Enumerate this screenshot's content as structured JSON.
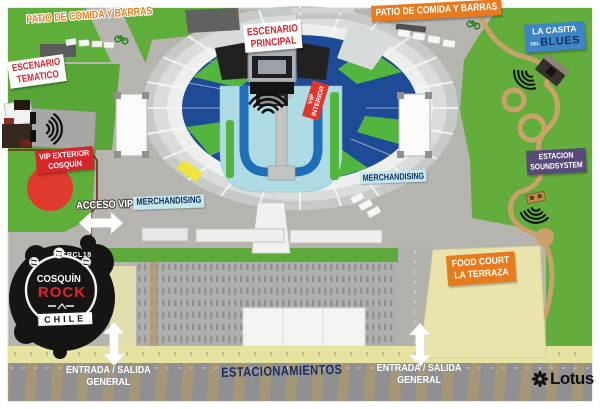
{
  "logo": {
    "hashtag": "#CRCL18",
    "line1": "COSQUÍN",
    "line2": "ROCK",
    "country": "CHILE"
  },
  "labels": {
    "patio_left": "PATIO DE COMIDA Y BARRAS",
    "patio_right": "PATIO DE COMIDA Y BARRAS",
    "escenario_principal_1": "ESCENARIO",
    "escenario_principal_2": "PRINCIPAL",
    "escenario_tematico_1": "ESCENARIO",
    "escenario_tematico_2": "TEMATICO",
    "vip_interior_1": "VIP",
    "vip_interior_2": "INTERIOR",
    "vip_exterior_1": "VIP EXTERIOR",
    "vip_exterior_2": "COSQUÍN",
    "acceso_vip": "ACCESO VIP",
    "merchandising_left": "MERCHANDISING",
    "merchandising_right": "MERCHANDISING",
    "casita_1": "LA CASITA",
    "casita_del": "DEL",
    "casita_2": "BLUES",
    "soundsystem_1": "ESTACION",
    "soundsystem_2": "SOUNDSYSTEM",
    "food_court_1": "FOOD COURT",
    "food_court_2": "LA TERRAZA",
    "estacionamientos": "ESTACIONAMIENTOS",
    "entrada_1": "ENTRADA / SALIDA",
    "entrada_2": "GENERAL"
  },
  "sponsor": {
    "name": "Lotus"
  },
  "colors": {
    "orange": "#e87b1e",
    "red": "#d6252b",
    "vip_red": "#e0342c",
    "navy_text": "#1b2d5e",
    "label_blue_bg": "#c6e6ee",
    "purple": "#594a7a",
    "casita_blue": "#3d85c6",
    "stadium_navy": "#1d4b96",
    "field_cyan": "#aedae3",
    "u_blue": "#1e6fb8",
    "grass_green": "#5fae3a",
    "road_yellow": "#e7e3a0",
    "plaza_gray": "#b6b4af",
    "logo_black": "#171513"
  }
}
